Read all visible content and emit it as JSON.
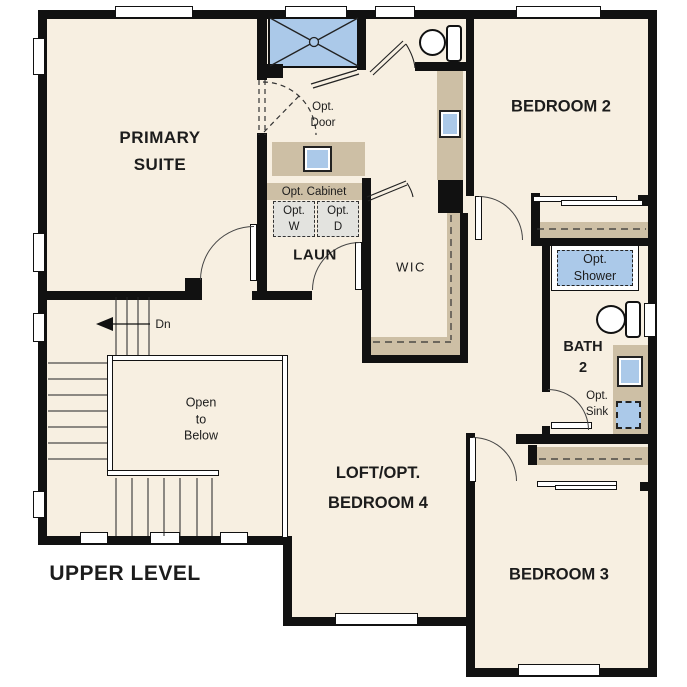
{
  "plan": {
    "title": "UPPER LEVEL",
    "rooms": {
      "primary_suite": "PRIMARY\nSUITE",
      "bedroom2": "BEDROOM 2",
      "bedroom3": "BEDROOM 3",
      "loft": "LOFT/OPT.\nBEDROOM 4",
      "laundry": "LAUN",
      "wic": "WIC",
      "bath2": "BATH\n2"
    },
    "annotations": {
      "opt_door": "Opt.\nDoor",
      "opt_cabinet": "Opt. Cabinet",
      "opt_washer": "Opt.\nW",
      "opt_dryer": "Opt.\nD",
      "opt_shower": "Opt.\nShower",
      "opt_sink": "Opt.\nSink",
      "open_to_below": "Open\nto\nBelow",
      "stairs_down": "Dn"
    },
    "colors": {
      "floor": "#f7efe1",
      "wall": "#111111",
      "fixture_blue": "#abc9e9",
      "cabinet_tan": "#cdbfa5",
      "appliance_gray": "#e3e3df",
      "text": "#1c1c1c"
    }
  }
}
